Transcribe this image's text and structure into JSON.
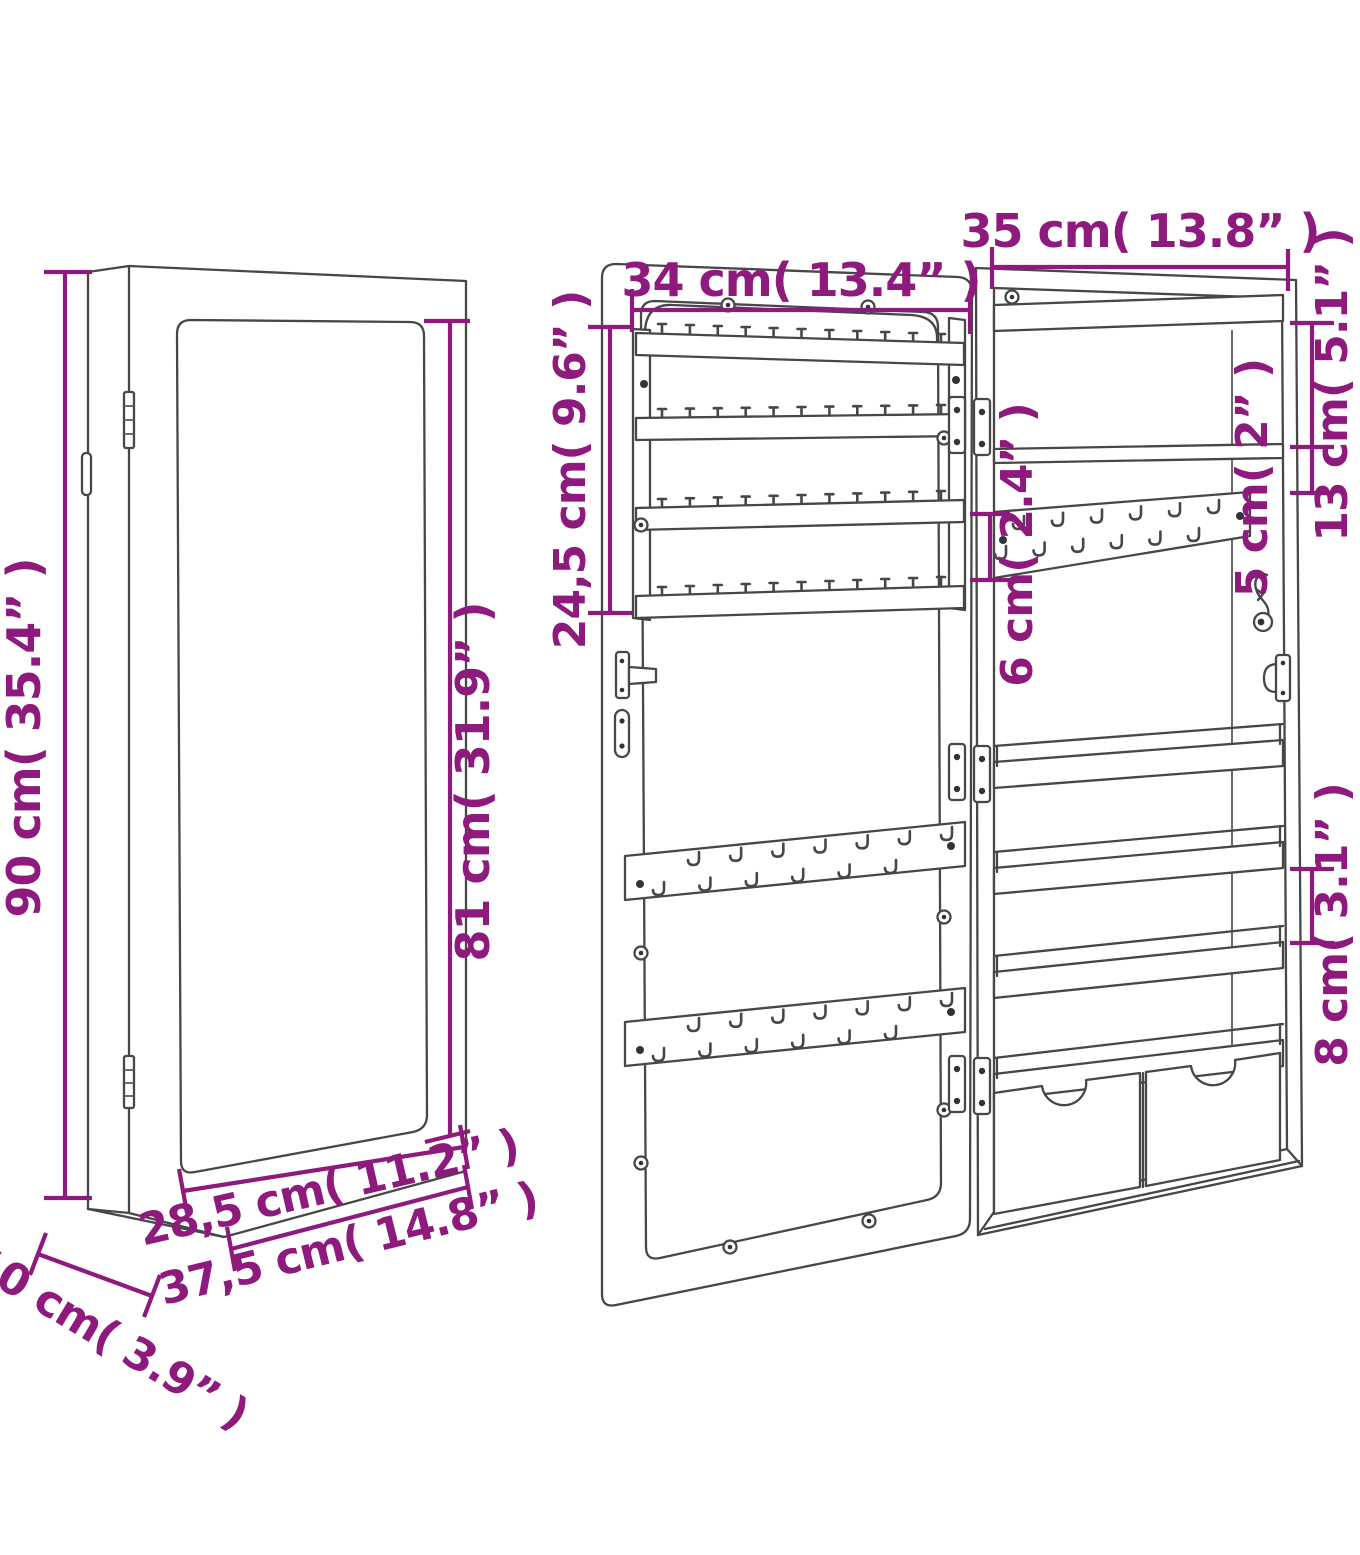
{
  "diagram": {
    "background": "#ffffff",
    "accent_color": "#8E1A7D",
    "line_color": "#474747",
    "views": {
      "closed": {
        "height": "90 cm( 35.4” )",
        "mirror_height": "81 cm( 31.9” )",
        "mirror_width": "28,5 cm( 11.2” )",
        "width": "37,5 cm( 14.8” )",
        "depth": "10 cm( 3.9” )"
      },
      "door": {
        "width": "34 cm( 13.4” )",
        "rack_height": "24,5 cm( 9.6” )"
      },
      "cabinet": {
        "width": "35 cm( 13.8” )",
        "top_compartment_height": "13 cm( 5.1” )",
        "upper_gap": "5 cm( 2” )",
        "hook_rail_height": "6 cm( 2.4” )",
        "shelf_gap": "8 cm( 3.1” )"
      }
    }
  }
}
